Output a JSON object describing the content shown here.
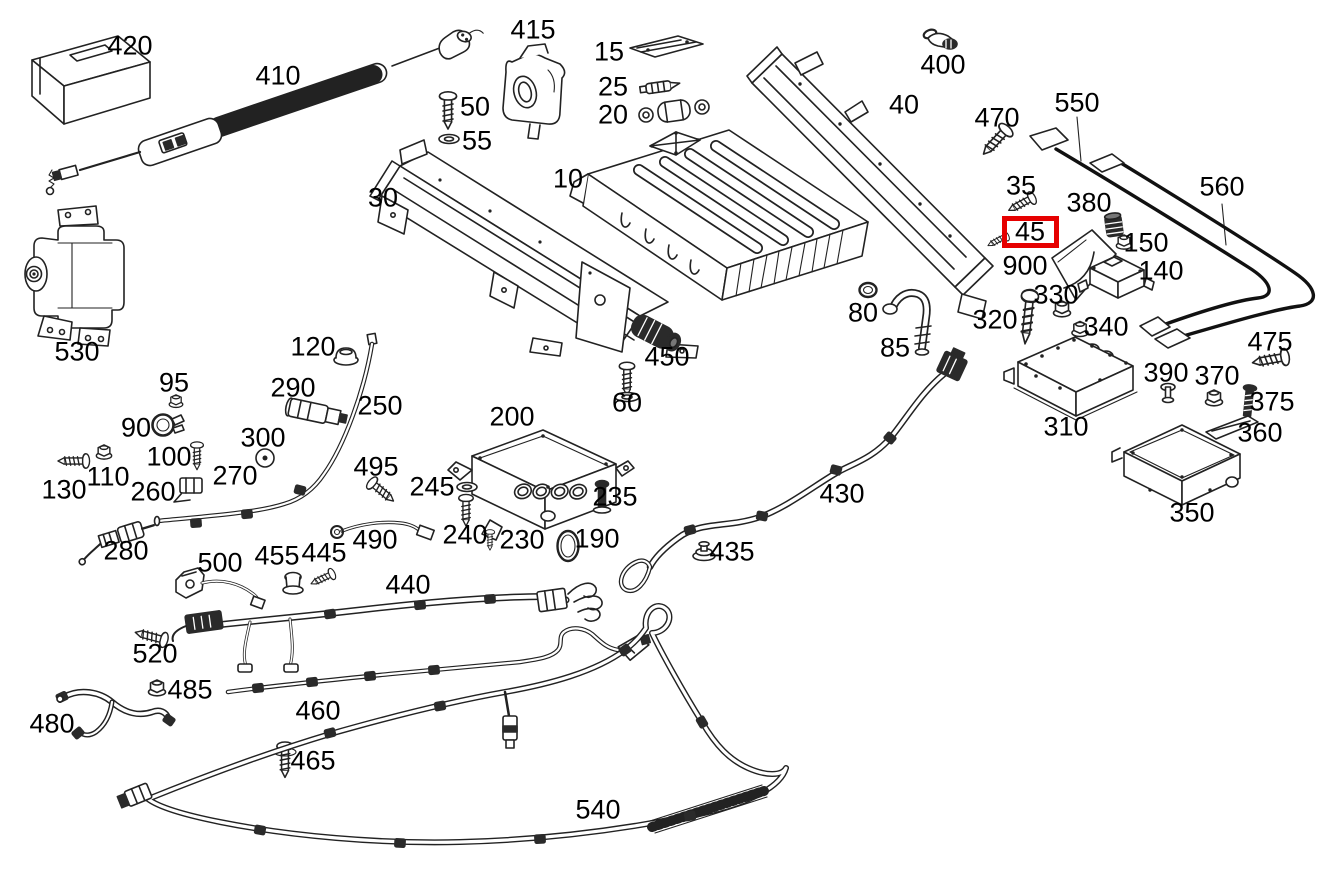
{
  "diagram": {
    "description": "Exploded parts diagram of a hybrid high-voltage battery system with numbered callouts",
    "background_color": "#ffffff",
    "line_color": "#222222",
    "label_color": "#000000",
    "highlight": {
      "part_id": "45",
      "color": "#e60000",
      "x": 1002,
      "y": 216,
      "width": 57,
      "height": 32
    },
    "labels": [
      {
        "id": "420",
        "x": 130,
        "y": 46
      },
      {
        "id": "410",
        "x": 278,
        "y": 76
      },
      {
        "id": "415",
        "x": 533,
        "y": 30
      },
      {
        "id": "50",
        "x": 475,
        "y": 107
      },
      {
        "id": "55",
        "x": 477,
        "y": 141
      },
      {
        "id": "15",
        "x": 609,
        "y": 52
      },
      {
        "id": "25",
        "x": 613,
        "y": 87
      },
      {
        "id": "20",
        "x": 613,
        "y": 115
      },
      {
        "id": "10",
        "x": 568,
        "y": 179
      },
      {
        "id": "30",
        "x": 383,
        "y": 198
      },
      {
        "id": "40",
        "x": 904,
        "y": 105
      },
      {
        "id": "400",
        "x": 943,
        "y": 65
      },
      {
        "id": "470",
        "x": 997,
        "y": 118
      },
      {
        "id": "550",
        "x": 1077,
        "y": 103
      },
      {
        "id": "560",
        "x": 1222,
        "y": 187
      },
      {
        "id": "35",
        "x": 1021,
        "y": 186
      },
      {
        "id": "45",
        "x": 1030,
        "y": 232,
        "highlighted": true
      },
      {
        "id": "380",
        "x": 1089,
        "y": 203
      },
      {
        "id": "900",
        "x": 1025,
        "y": 266
      },
      {
        "id": "150",
        "x": 1146,
        "y": 243
      },
      {
        "id": "140",
        "x": 1161,
        "y": 271
      },
      {
        "id": "330",
        "x": 1056,
        "y": 295
      },
      {
        "id": "320",
        "x": 995,
        "y": 320
      },
      {
        "id": "340",
        "x": 1106,
        "y": 327
      },
      {
        "id": "80",
        "x": 863,
        "y": 313
      },
      {
        "id": "85",
        "x": 895,
        "y": 348
      },
      {
        "id": "475",
        "x": 1270,
        "y": 342
      },
      {
        "id": "530",
        "x": 77,
        "y": 352
      },
      {
        "id": "120",
        "x": 313,
        "y": 347
      },
      {
        "id": "95",
        "x": 174,
        "y": 383
      },
      {
        "id": "290",
        "x": 293,
        "y": 388
      },
      {
        "id": "250",
        "x": 380,
        "y": 406
      },
      {
        "id": "90",
        "x": 136,
        "y": 428
      },
      {
        "id": "300",
        "x": 263,
        "y": 438
      },
      {
        "id": "100",
        "x": 169,
        "y": 457
      },
      {
        "id": "450",
        "x": 667,
        "y": 357
      },
      {
        "id": "60",
        "x": 627,
        "y": 403
      },
      {
        "id": "310",
        "x": 1066,
        "y": 427
      },
      {
        "id": "390",
        "x": 1166,
        "y": 373
      },
      {
        "id": "370",
        "x": 1217,
        "y": 376
      },
      {
        "id": "375",
        "x": 1272,
        "y": 402
      },
      {
        "id": "360",
        "x": 1260,
        "y": 433
      },
      {
        "id": "130",
        "x": 64,
        "y": 490
      },
      {
        "id": "110",
        "x": 108,
        "y": 477
      },
      {
        "id": "260",
        "x": 153,
        "y": 492
      },
      {
        "id": "270",
        "x": 235,
        "y": 476
      },
      {
        "id": "495",
        "x": 376,
        "y": 467
      },
      {
        "id": "245",
        "x": 432,
        "y": 487
      },
      {
        "id": "200",
        "x": 512,
        "y": 417
      },
      {
        "id": "235",
        "x": 615,
        "y": 497
      },
      {
        "id": "430",
        "x": 842,
        "y": 494
      },
      {
        "id": "350",
        "x": 1192,
        "y": 513
      },
      {
        "id": "280",
        "x": 126,
        "y": 551
      },
      {
        "id": "240",
        "x": 465,
        "y": 535
      },
      {
        "id": "230",
        "x": 522,
        "y": 540
      },
      {
        "id": "190",
        "x": 597,
        "y": 539
      },
      {
        "id": "435",
        "x": 732,
        "y": 552
      },
      {
        "id": "500",
        "x": 220,
        "y": 563
      },
      {
        "id": "455",
        "x": 277,
        "y": 556
      },
      {
        "id": "445",
        "x": 324,
        "y": 553
      },
      {
        "id": "490",
        "x": 375,
        "y": 540
      },
      {
        "id": "440",
        "x": 408,
        "y": 585
      },
      {
        "id": "520",
        "x": 155,
        "y": 654
      },
      {
        "id": "485",
        "x": 190,
        "y": 690
      },
      {
        "id": "480",
        "x": 52,
        "y": 724
      },
      {
        "id": "460",
        "x": 318,
        "y": 711
      },
      {
        "id": "465",
        "x": 313,
        "y": 761
      },
      {
        "id": "540",
        "x": 598,
        "y": 810
      }
    ]
  }
}
